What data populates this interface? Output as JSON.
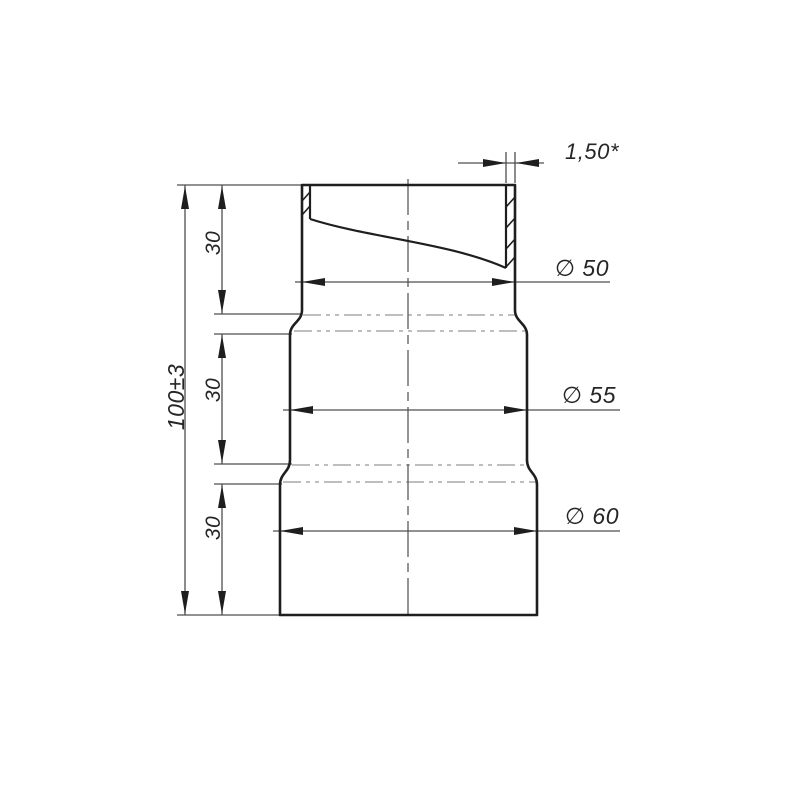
{
  "page": {
    "background_color": "#ffffff"
  },
  "drawing": {
    "kind": "sectioned front view of a three-step pipe reducer",
    "colors": {
      "outline": "#1e1e1e",
      "thin_lines": "#4f4f4f",
      "phantom_lines": "#a9a9a9",
      "text": "#262626"
    },
    "labels": {
      "wall_thickness": "1,50*",
      "diameter_top": "∅ 50",
      "diameter_middle": "∅ 55",
      "diameter_bottom": "∅ 60",
      "height_total": "100±3",
      "height_top": "30",
      "height_middle": "30",
      "height_bottom": "30"
    }
  }
}
